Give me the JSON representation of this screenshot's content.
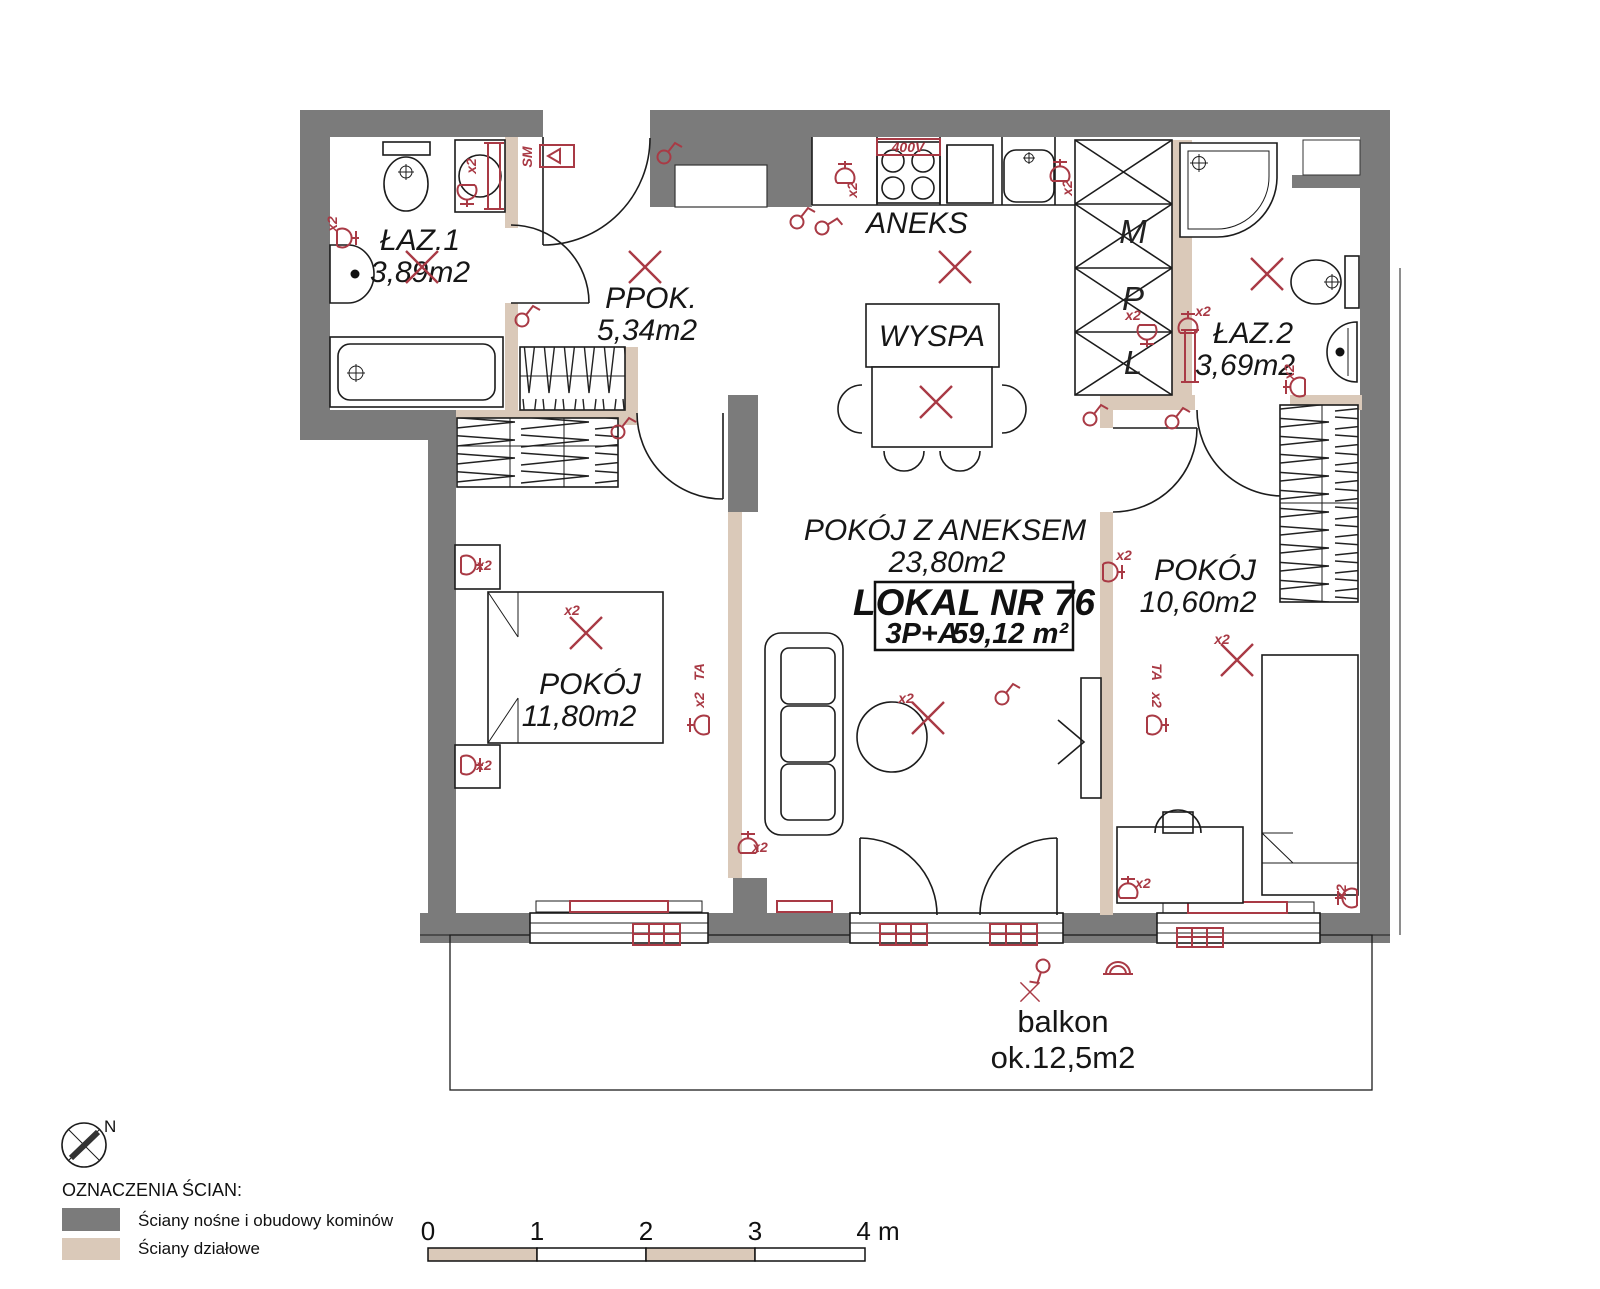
{
  "colors": {
    "wall_load_bearing": "#7b7b7b",
    "wall_partition": "#dac9b9",
    "annotation_red": "#a93a45",
    "line": "#1c1c1c",
    "background": "#ffffff"
  },
  "rooms": {
    "laz1": {
      "name": "ŁAZ.1",
      "area": "3,89m2"
    },
    "ppok": {
      "name": "PPOK.",
      "area": "5,34m2"
    },
    "aneks": {
      "name": "ANEKS"
    },
    "wyspa": {
      "name": "WYSPA"
    },
    "laz2": {
      "name": "ŁAZ.2",
      "area": "3,69m2"
    },
    "living": {
      "name": "POKÓJ Z ANEKSEM",
      "area": "23,80m2"
    },
    "bedroom_left": {
      "name": "POKÓJ",
      "area": "11,80m2"
    },
    "bedroom_right": {
      "name": "POKÓJ",
      "area": "10,60m2"
    },
    "balcony": {
      "name": "balkon",
      "area": "ok.12,5m2"
    }
  },
  "unit": {
    "number": "LOKAL NR 76",
    "layout": "3P+A",
    "total_area": "59,12 m²"
  },
  "shaft": {
    "letters": [
      "M",
      "P",
      "L"
    ]
  },
  "annotations": {
    "x2": "x2",
    "sm": "SM",
    "power": "400V",
    "tv": "TA",
    "north": "N"
  },
  "legend": {
    "title": "OZNACZENIA ŚCIAN:",
    "items": [
      {
        "label": "Ściany nośne i obudowy kominów",
        "color": "#7b7b7b"
      },
      {
        "label": "Ściany działowe",
        "color": "#dac9b9"
      }
    ]
  },
  "scale_bar": {
    "ticks": [
      "0",
      "1",
      "2",
      "3"
    ],
    "end_label": "4 m"
  }
}
